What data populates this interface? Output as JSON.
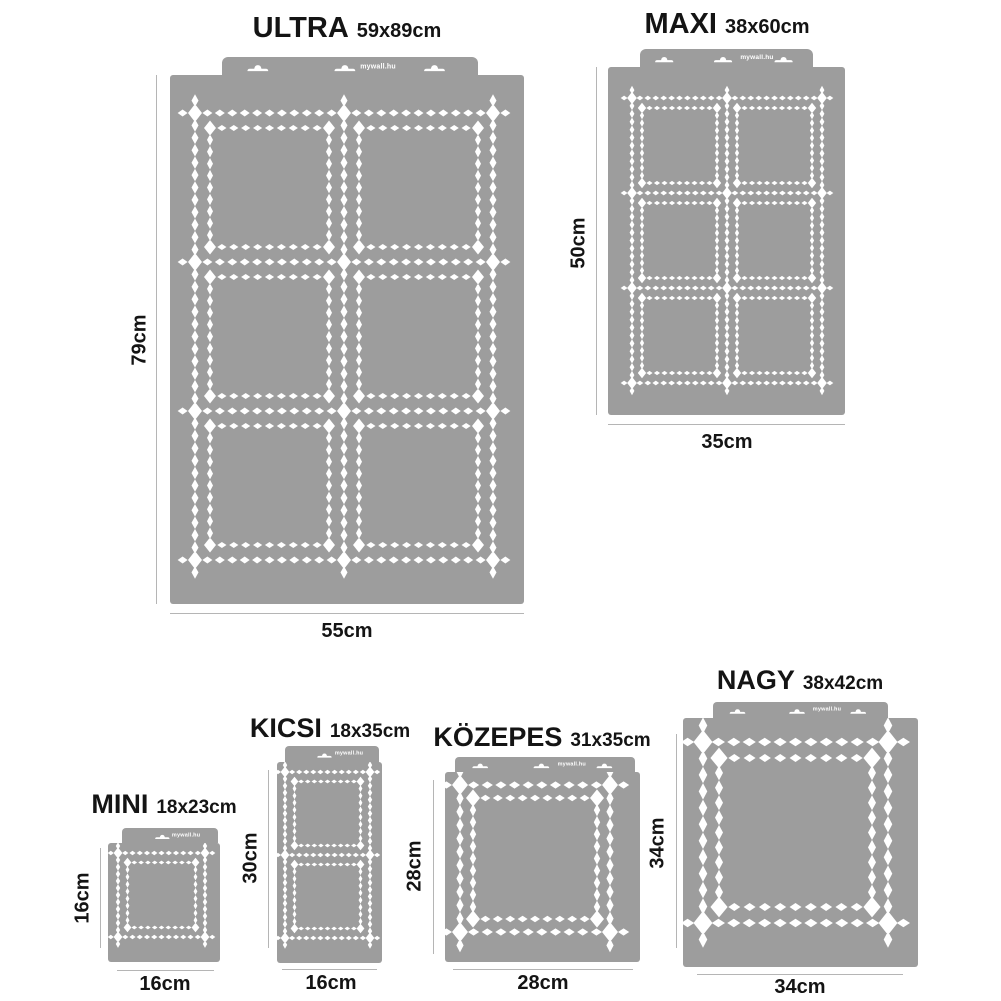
{
  "brand": "mywall.hu",
  "colors": {
    "stencil_gray": "#9d9d9d",
    "cutout_white": "#ffffff",
    "label_text": "#141414",
    "dim_line": "#b5b5b5"
  },
  "stencils": [
    {
      "id": "ultra",
      "name": "ULTRA",
      "size": "59x89cm",
      "height_label": "79cm",
      "width_label": "55cm",
      "grid": {
        "cols": 2,
        "rows": 3
      }
    },
    {
      "id": "maxi",
      "name": "MAXI",
      "size": "38x60cm",
      "height_label": "50cm",
      "width_label": "35cm",
      "grid": {
        "cols": 2,
        "rows": 3
      }
    },
    {
      "id": "mini",
      "name": "MINI",
      "size": "18x23cm",
      "height_label": "16cm",
      "width_label": "16cm",
      "grid": {
        "cols": 1,
        "rows": 1
      }
    },
    {
      "id": "kicsi",
      "name": "KICSI",
      "size": "18x35cm",
      "height_label": "30cm",
      "width_label": "16cm",
      "grid": {
        "cols": 1,
        "rows": 2
      }
    },
    {
      "id": "kozepes",
      "name": "KÖZEPES",
      "size": "31x35cm",
      "height_label": "28cm",
      "width_label": "28cm",
      "grid": {
        "cols": 1,
        "rows": 1
      }
    },
    {
      "id": "nagy",
      "name": "NAGY",
      "size": "38x42cm",
      "height_label": "34cm",
      "width_label": "34cm",
      "grid": {
        "cols": 1,
        "rows": 1
      }
    }
  ]
}
